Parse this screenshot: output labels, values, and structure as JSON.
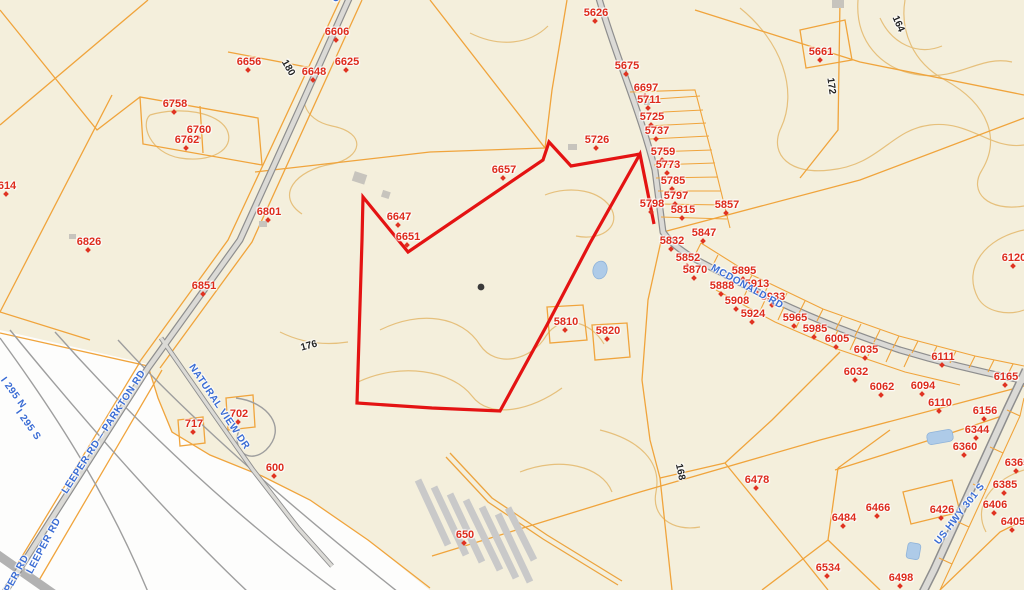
{
  "map": {
    "type": "gis-parcel-map",
    "colors": {
      "background": "#f4efdc",
      "outside_area": "#fdfdfc",
      "parcel_line": "#f0a43c",
      "contour_line": "#e6c07c",
      "road_fill": "#dbdad6",
      "road_casing": "#8e8e8e",
      "ramp_line": "#9e9e9e",
      "highlight_outline": "#e41313",
      "parcel_label": "#dd2b1c",
      "road_label": "#3a6cd4",
      "water": "#aecbe8"
    },
    "parcel_labels": [
      {
        "t": "5626",
        "x": 596,
        "y": 13
      },
      {
        "t": "6606",
        "x": 337,
        "y": 32
      },
      {
        "t": "5661",
        "x": 821,
        "y": 52
      },
      {
        "t": "6656",
        "x": 249,
        "y": 62
      },
      {
        "t": "6625",
        "x": 347,
        "y": 62
      },
      {
        "t": "6648",
        "x": 314,
        "y": 72
      },
      {
        "t": "5675",
        "x": 627,
        "y": 66
      },
      {
        "t": "6697",
        "x": 646,
        "y": 88
      },
      {
        "t": "6758",
        "x": 175,
        "y": 104
      },
      {
        "t": "5711",
        "x": 649,
        "y": 100
      },
      {
        "t": "5725",
        "x": 652,
        "y": 117
      },
      {
        "t": "5737",
        "x": 657,
        "y": 131
      },
      {
        "t": "6760",
        "x": 199,
        "y": 130
      },
      {
        "t": "6762",
        "x": 187,
        "y": 140
      },
      {
        "t": "5726",
        "x": 597,
        "y": 140
      },
      {
        "t": "5759",
        "x": 663,
        "y": 152
      },
      {
        "t": "5773",
        "x": 668,
        "y": 165
      },
      {
        "t": "6657",
        "x": 504,
        "y": 170
      },
      {
        "t": "5785",
        "x": 673,
        "y": 181
      },
      {
        "t": "614",
        "x": 7,
        "y": 186
      },
      {
        "t": "5797",
        "x": 676,
        "y": 196
      },
      {
        "t": "5798",
        "x": 652,
        "y": 204
      },
      {
        "t": "5857",
        "x": 727,
        "y": 205
      },
      {
        "t": "5815",
        "x": 683,
        "y": 210
      },
      {
        "t": "6801",
        "x": 269,
        "y": 212
      },
      {
        "t": "6647",
        "x": 399,
        "y": 217
      },
      {
        "t": "5847",
        "x": 704,
        "y": 233
      },
      {
        "t": "6651",
        "x": 408,
        "y": 237
      },
      {
        "t": "5832",
        "x": 672,
        "y": 241
      },
      {
        "t": "6826",
        "x": 89,
        "y": 242
      },
      {
        "t": "6120",
        "x": 1014,
        "y": 258
      },
      {
        "t": "5852",
        "x": 688,
        "y": 258
      },
      {
        "t": "5870",
        "x": 695,
        "y": 270
      },
      {
        "t": "5895",
        "x": 744,
        "y": 271
      },
      {
        "t": "6851",
        "x": 204,
        "y": 286
      },
      {
        "t": "5888",
        "x": 722,
        "y": 286
      },
      {
        "t": "5913",
        "x": 757,
        "y": 284
      },
      {
        "t": "5908",
        "x": 737,
        "y": 301
      },
      {
        "t": "5933",
        "x": 773,
        "y": 297
      },
      {
        "t": "5924",
        "x": 753,
        "y": 314
      },
      {
        "t": "5965",
        "x": 795,
        "y": 318
      },
      {
        "t": "5810",
        "x": 566,
        "y": 322
      },
      {
        "t": "5985",
        "x": 815,
        "y": 329
      },
      {
        "t": "5820",
        "x": 608,
        "y": 331
      },
      {
        "t": "6005",
        "x": 837,
        "y": 339
      },
      {
        "t": "6035",
        "x": 866,
        "y": 350
      },
      {
        "t": "6111",
        "x": 943,
        "y": 357
      },
      {
        "t": "6032",
        "x": 856,
        "y": 372
      },
      {
        "t": "6165",
        "x": 1006,
        "y": 377
      },
      {
        "t": "6062",
        "x": 882,
        "y": 387
      },
      {
        "t": "6094",
        "x": 923,
        "y": 386
      },
      {
        "t": "6110",
        "x": 940,
        "y": 403
      },
      {
        "t": "6156",
        "x": 985,
        "y": 411
      },
      {
        "t": "717",
        "x": 194,
        "y": 424
      },
      {
        "t": "702",
        "x": 239,
        "y": 414
      },
      {
        "t": "6344",
        "x": 977,
        "y": 430
      },
      {
        "t": "6360",
        "x": 965,
        "y": 447
      },
      {
        "t": "6365",
        "x": 1017,
        "y": 463
      },
      {
        "t": "600",
        "x": 275,
        "y": 468
      },
      {
        "t": "6478",
        "x": 757,
        "y": 480
      },
      {
        "t": "6385",
        "x": 1005,
        "y": 485
      },
      {
        "t": "6406",
        "x": 995,
        "y": 505
      },
      {
        "t": "6405",
        "x": 1013,
        "y": 522
      },
      {
        "t": "6466",
        "x": 878,
        "y": 508
      },
      {
        "t": "6426",
        "x": 942,
        "y": 510
      },
      {
        "t": "6484",
        "x": 844,
        "y": 518
      },
      {
        "t": "650",
        "x": 465,
        "y": 535
      },
      {
        "t": "6534",
        "x": 828,
        "y": 568
      },
      {
        "t": "6498",
        "x": 901,
        "y": 578
      }
    ],
    "road_labels": [
      {
        "t": "PARKTON RD",
        "x": 322,
        "y": -30,
        "r": 65
      },
      {
        "t": "LEEPER RD – PARKTON RD",
        "x": 104,
        "y": 432,
        "r": -57
      },
      {
        "t": "LEEPER RD",
        "x": 44,
        "y": 546,
        "r": -62
      },
      {
        "t": "LEEPER RD",
        "x": 12,
        "y": 583,
        "r": -62
      },
      {
        "t": "NATURAL VIEW DR",
        "x": 219,
        "y": 407,
        "r": 56
      },
      {
        "t": "MCDONALD RD",
        "x": 747,
        "y": 287,
        "r": 29
      },
      {
        "t": "US HWY 301 S",
        "x": 960,
        "y": 514,
        "r": -52
      },
      {
        "t": "I 295 N",
        "x": 13,
        "y": 393,
        "r": 54
      },
      {
        "t": "I 295 S",
        "x": 28,
        "y": 425,
        "r": 54
      }
    ],
    "contour_labels": [
      {
        "t": "180",
        "x": 288,
        "y": 68,
        "r": 60
      },
      {
        "t": "176",
        "x": 309,
        "y": 346,
        "r": -15
      },
      {
        "t": "172",
        "x": 831,
        "y": 86,
        "r": 82
      },
      {
        "t": "164",
        "x": 898,
        "y": 24,
        "r": 66
      },
      {
        "t": "168",
        "x": 680,
        "y": 472,
        "r": 78
      }
    ]
  }
}
